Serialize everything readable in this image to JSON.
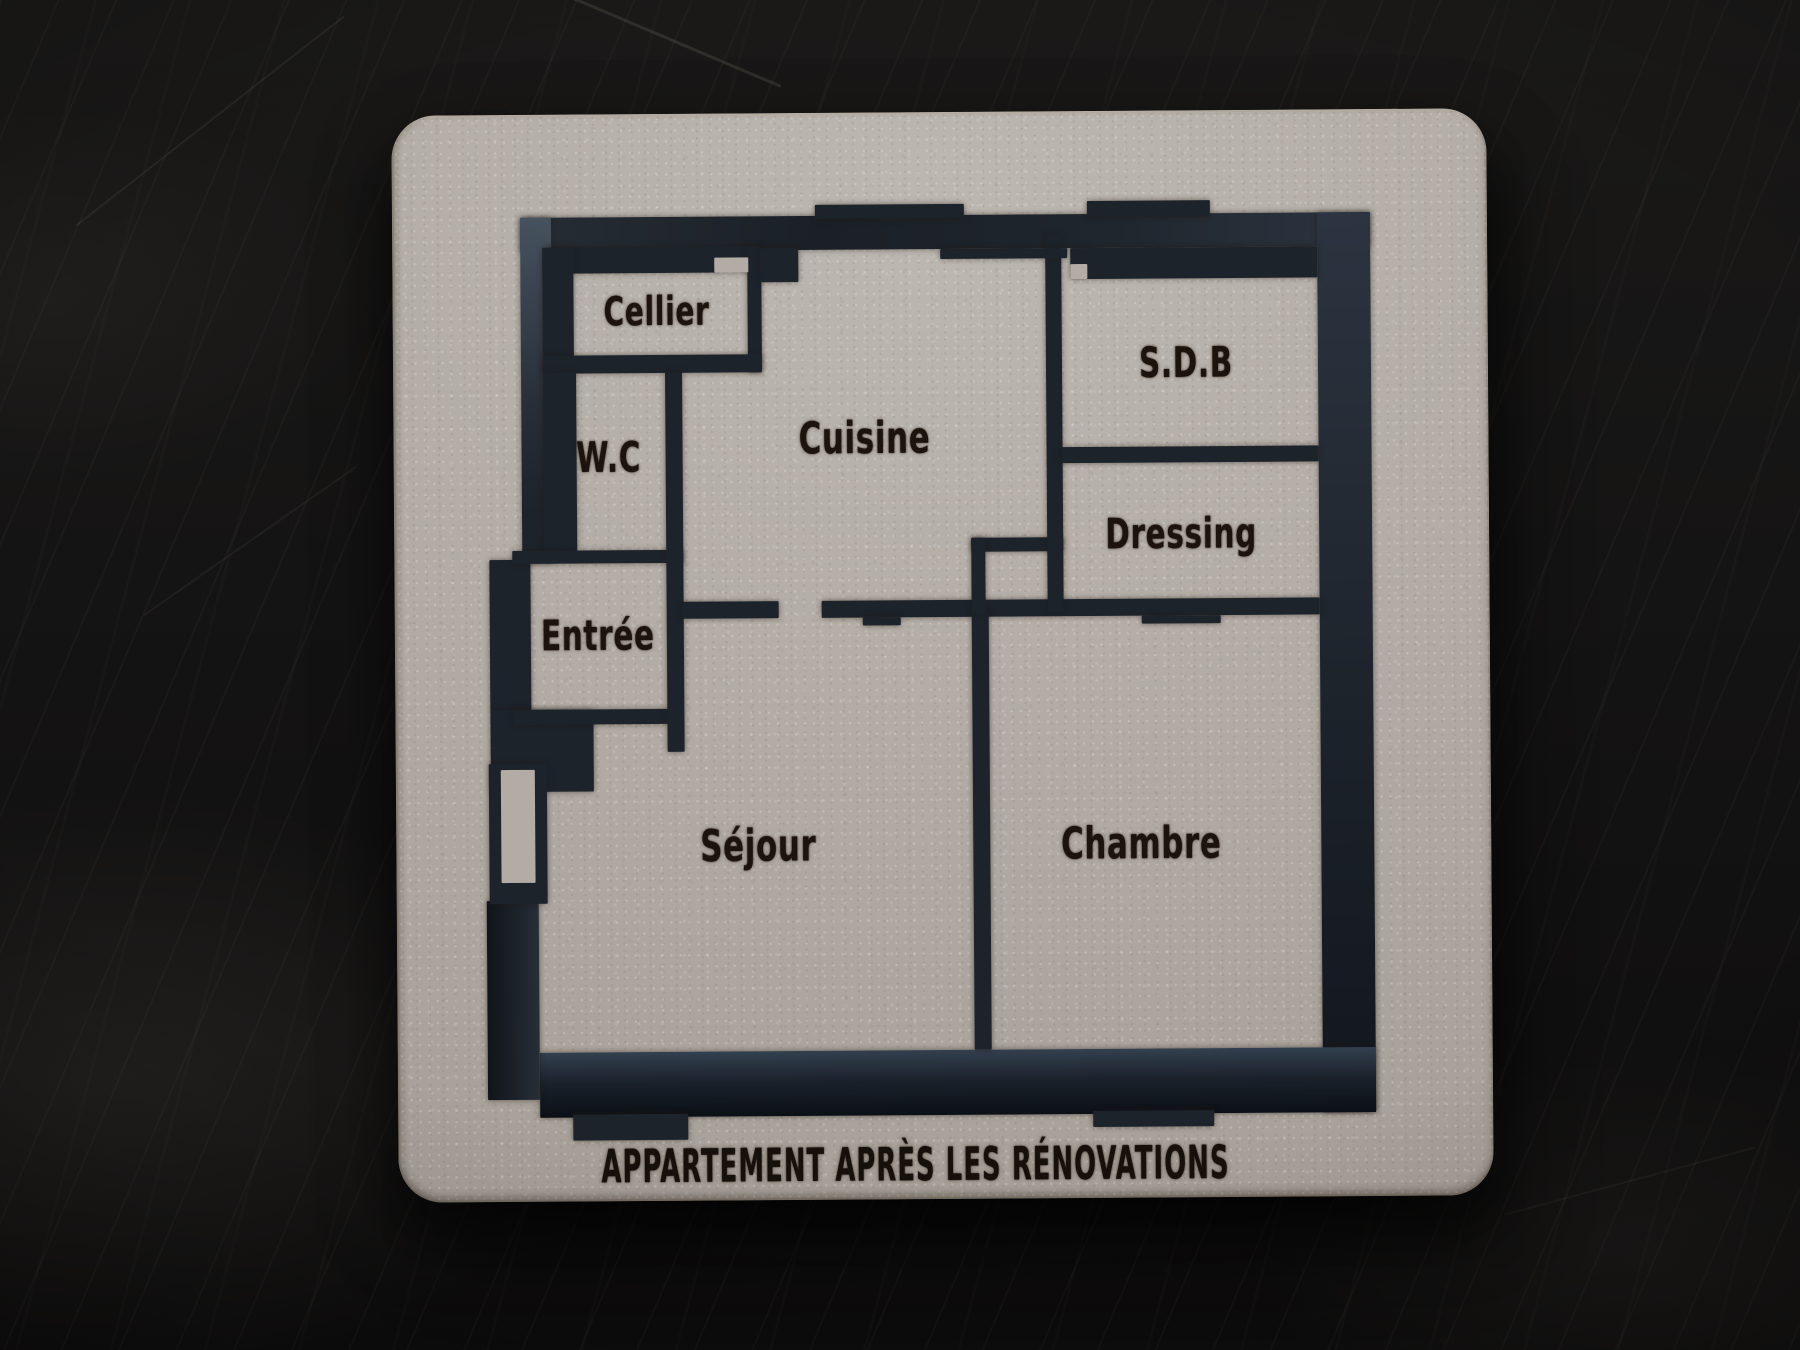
{
  "board": {
    "caption": "APPARTEMENT APRÈS LES RÉNOVATIONS",
    "caption_center": {
      "x": 517,
      "y": 1052
    }
  },
  "colors": {
    "board": "#b3ada6",
    "wall_channel": "#1d232b",
    "engraving": "#1b130c",
    "table": "#141313"
  },
  "plan": {
    "rooms": [
      {
        "id": "cellier",
        "label": "Cellier",
        "x": 189,
        "y": 115,
        "size": 40
      },
      {
        "id": "wc",
        "label": "W.C",
        "x": 140,
        "y": 260,
        "size": 42
      },
      {
        "id": "cuisine",
        "label": "Cuisine",
        "x": 396,
        "y": 243,
        "size": 44
      },
      {
        "id": "sdb",
        "label": "S.D.B",
        "x": 718,
        "y": 169,
        "size": 42
      },
      {
        "id": "dressing",
        "label": "Dressing",
        "x": 712,
        "y": 340,
        "size": 42
      },
      {
        "id": "entree",
        "label": "Entrée",
        "x": 128,
        "y": 438,
        "size": 42
      },
      {
        "id": "sejour",
        "label": "Séjour",
        "x": 287,
        "y": 650,
        "size": 44
      },
      {
        "id": "chambre",
        "label": "Chambre",
        "x": 670,
        "y": 650,
        "size": 44
      }
    ],
    "walls": [
      {
        "name": "outer-wall-top",
        "x": 53,
        "y": 20,
        "w": 850,
        "h": 34,
        "shade": "top"
      },
      {
        "name": "outer-wall-top-tab-1",
        "x": 348,
        "y": 9,
        "w": 149,
        "h": 14
      },
      {
        "name": "outer-wall-top-tab-2",
        "x": 620,
        "y": 7,
        "w": 123,
        "h": 16
      },
      {
        "name": "outer-wall-right",
        "x": 850,
        "y": 20,
        "w": 53,
        "h": 900,
        "shade": "right"
      },
      {
        "name": "outer-wall-bottom",
        "x": 67,
        "y": 855,
        "w": 836,
        "h": 65,
        "shade": "bottom"
      },
      {
        "name": "outer-wall-bottom-tab-1",
        "x": 100,
        "y": 917,
        "w": 115,
        "h": 26
      },
      {
        "name": "outer-wall-bottom-tab-2",
        "x": 620,
        "y": 917,
        "w": 121,
        "h": 16
      },
      {
        "name": "outer-wall-left-upper",
        "x": 53,
        "y": 20,
        "w": 31,
        "h": 345,
        "shade": "left"
      },
      {
        "name": "entree-left-wall",
        "x": 20,
        "y": 362,
        "w": 41,
        "h": 151
      },
      {
        "name": "outer-wall-left-lower",
        "x": 15,
        "y": 703,
        "w": 52,
        "h": 199,
        "shade": "leftlow"
      },
      {
        "name": "entree-bottom-block",
        "x": 20,
        "y": 512,
        "w": 103,
        "h": 82
      },
      {
        "name": "entree-bottom-wall",
        "x": 43,
        "y": 512,
        "w": 158,
        "h": 15
      },
      {
        "name": "entry-door-block",
        "x": 18,
        "y": 566,
        "w": 58,
        "h": 140
      },
      {
        "name": "cellier-top-wall",
        "x": 83,
        "y": 50,
        "w": 211,
        "h": 26
      },
      {
        "name": "cellier-left-wall",
        "x": 75,
        "y": 50,
        "w": 31,
        "h": 126
      },
      {
        "name": "cellier-right-wall",
        "x": 280,
        "y": 50,
        "w": 14,
        "h": 126
      },
      {
        "name": "cuisine-topleft-step",
        "x": 293,
        "y": 52,
        "w": 38,
        "h": 34
      },
      {
        "name": "cellier-bottom-wall",
        "x": 75,
        "y": 158,
        "w": 219,
        "h": 18
      },
      {
        "name": "wc-left-wall",
        "x": 75,
        "y": 175,
        "w": 33,
        "h": 179
      },
      {
        "name": "wc-bottom-wall",
        "x": 43,
        "y": 353,
        "w": 171,
        "h": 13
      },
      {
        "name": "wc-entree-divider-wall",
        "x": 197,
        "y": 175,
        "w": 17,
        "h": 380
      },
      {
        "name": "cuisine-bottom-wall-left",
        "x": 213,
        "y": 405,
        "w": 96,
        "h": 17
      },
      {
        "name": "cuisine-bottom-wall-right",
        "x": 352,
        "y": 405,
        "w": 498,
        "h": 17
      },
      {
        "name": "sejour-door-tab",
        "x": 393,
        "y": 422,
        "w": 38,
        "h": 8
      },
      {
        "name": "chambre-door-tab",
        "x": 672,
        "y": 422,
        "w": 79,
        "h": 8
      },
      {
        "name": "sejour-chambre-divider-wall",
        "x": 502,
        "y": 418,
        "w": 17,
        "h": 437
      },
      {
        "name": "duct-top-wall",
        "x": 502,
        "y": 343,
        "w": 92,
        "h": 14
      },
      {
        "name": "duct-left-wall",
        "x": 502,
        "y": 343,
        "w": 14,
        "h": 76
      },
      {
        "name": "cuisine-sdb-divider-wall",
        "x": 578,
        "y": 40,
        "w": 16,
        "h": 378
      },
      {
        "name": "sdb-top-wall",
        "x": 603,
        "y": 54,
        "w": 247,
        "h": 31
      },
      {
        "name": "sdb-dressing-divider-wall",
        "x": 593,
        "y": 253,
        "w": 257,
        "h": 16
      },
      {
        "name": "cuisine-top-door-tab",
        "x": 473,
        "y": 54,
        "w": 127,
        "h": 10
      }
    ],
    "cutouts": [
      {
        "name": "entry-door-tab-cutout",
        "x": 30,
        "y": 572,
        "w": 34,
        "h": 113
      },
      {
        "name": "cellier-door-cutout",
        "x": 247,
        "y": 61,
        "w": 34,
        "h": 15
      },
      {
        "name": "sdb-door-cutout",
        "x": 603,
        "y": 70,
        "w": 17,
        "h": 15
      }
    ]
  }
}
